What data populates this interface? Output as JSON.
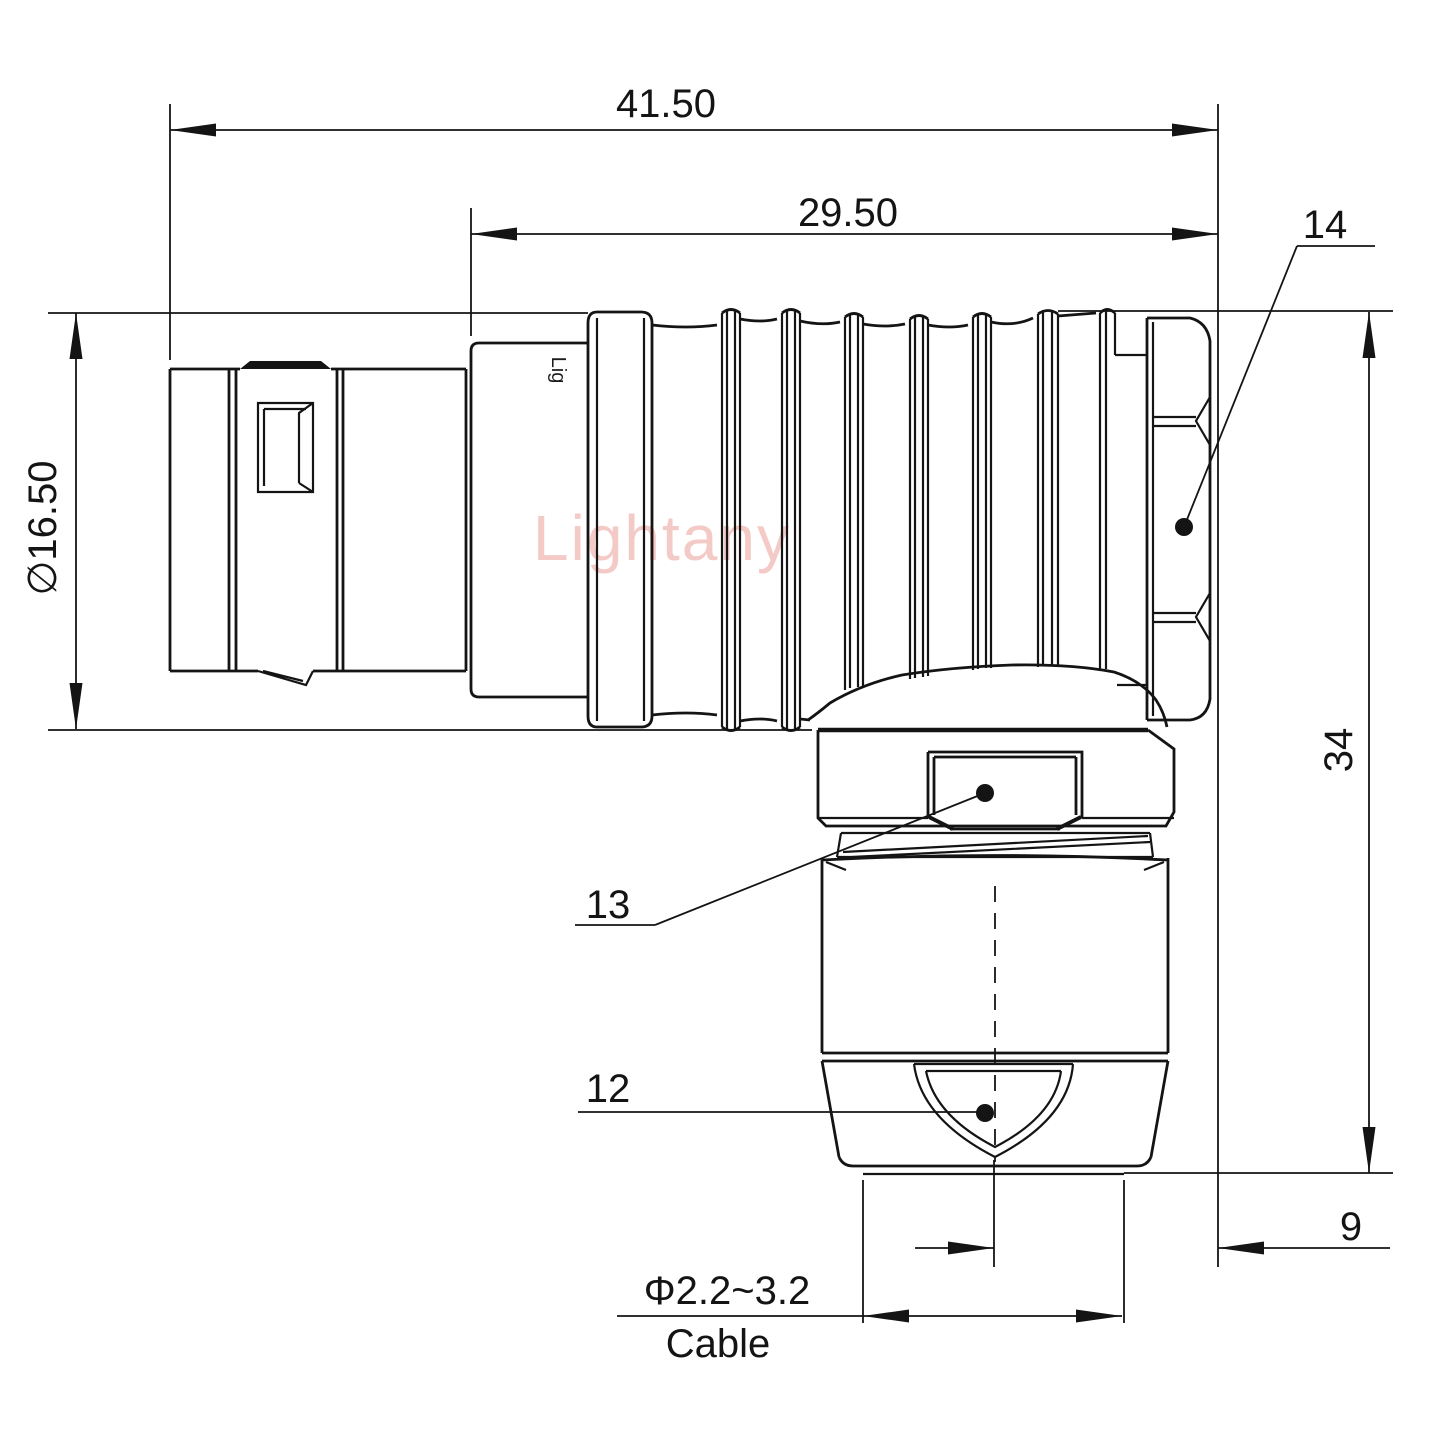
{
  "drawing": {
    "watermark": "Lightany",
    "body_mark": "Lig",
    "dimensions": {
      "overall_length": "41.50",
      "rear_length": "29.50",
      "shell_diameter": "∅16.50",
      "overall_height": "34",
      "axis_offset": "9",
      "cable_diameter": "Φ2.2~3.2",
      "cable_word": "Cable"
    },
    "part_labels": {
      "backnut_label": "14",
      "elbow_nut_label": "13",
      "cable_clamp_label": "12"
    },
    "colors": {
      "line": "#141414",
      "watermark": "#f4cac6",
      "background": "#ffffff"
    }
  }
}
